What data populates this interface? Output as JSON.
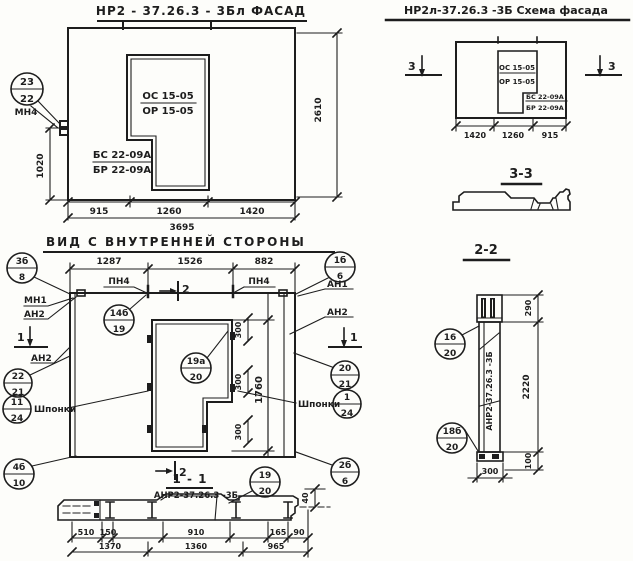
{
  "colors": {
    "ink": "#1d1d1d",
    "paper": "#fdfdfa"
  },
  "facade": {
    "title": "НР2 - 37.26.3  - 3Бл  ФАСАД",
    "window_ref1": "ОС 15-05",
    "window_ref2": "ОР 15-05",
    "block_ref1": "БС 22-09А",
    "block_ref2": "БР 22-09А",
    "node_num": "23",
    "node_sheet": "22",
    "node_label": "МН4",
    "dim_height_left": "1020",
    "dim_height_right": "2610",
    "dim_b1": "915",
    "dim_b2": "1260",
    "dim_b3": "1420",
    "dim_total": "3695"
  },
  "schema": {
    "title": "НР2л-37.26.3  -3Б  Схема фасада",
    "mark": "3",
    "window_ref1": "ОС 15-05",
    "window_ref2": "ОР 15-05",
    "block_ref1": "БС 22-09А",
    "block_ref2": "БР 22-09А",
    "dim_b1": "1420",
    "dim_b2": "1260",
    "dim_b3": "915"
  },
  "section33": {
    "title": "3-3"
  },
  "section22": {
    "title": "2-2",
    "node_top_num": "16",
    "node_top_sheet": "20",
    "node_bot_num": "18б",
    "node_bot_sheet": "20",
    "body_label": "АНР2-37.26.3 -3Б",
    "dim_top": "290",
    "dim_height": "2220",
    "dim_low": "100",
    "dim_width": "300"
  },
  "inner": {
    "title": "ВИД  С  ВНУТРЕННЕЙ  СТОРОНЫ",
    "dim_t1": "1287",
    "dim_t2": "1526",
    "dim_t3": "882",
    "pn": "ПН4",
    "mark1": "1",
    "mark2": "2",
    "mn1": "МН1",
    "an1": "АН1",
    "an2": "АН2",
    "shponki": "Шпонки",
    "n3b_num": "3б",
    "n3b_sheet": "8",
    "n14b_num": "14б",
    "n14b_sheet": "19",
    "n1b_num": "1б",
    "n1b_sheet": "6",
    "n22_num": "22",
    "n22_sheet": "21",
    "n20_num": "20",
    "n20_sheet": "21",
    "n11_num": "11",
    "n11_sheet": "24",
    "n1_num": "1",
    "n1_sheet": "24",
    "n4b_num": "4б",
    "n4b_sheet": "10",
    "n2b_num": "2б",
    "n2b_sheet": "6",
    "n19a_num": "19а",
    "n19a_sheet": "20",
    "dim_300": "300",
    "dim_height": "1760"
  },
  "section11": {
    "title": "1 - 1",
    "mark2": "2",
    "label": "АНР2-37.26.3 -3Б",
    "node_num": "19",
    "node_sheet": "20",
    "dim_r1": [
      "510",
      "150",
      "910",
      "165",
      "90"
    ],
    "dim_r2": [
      "1370",
      "1360",
      "965"
    ],
    "dim_offset": "40"
  }
}
